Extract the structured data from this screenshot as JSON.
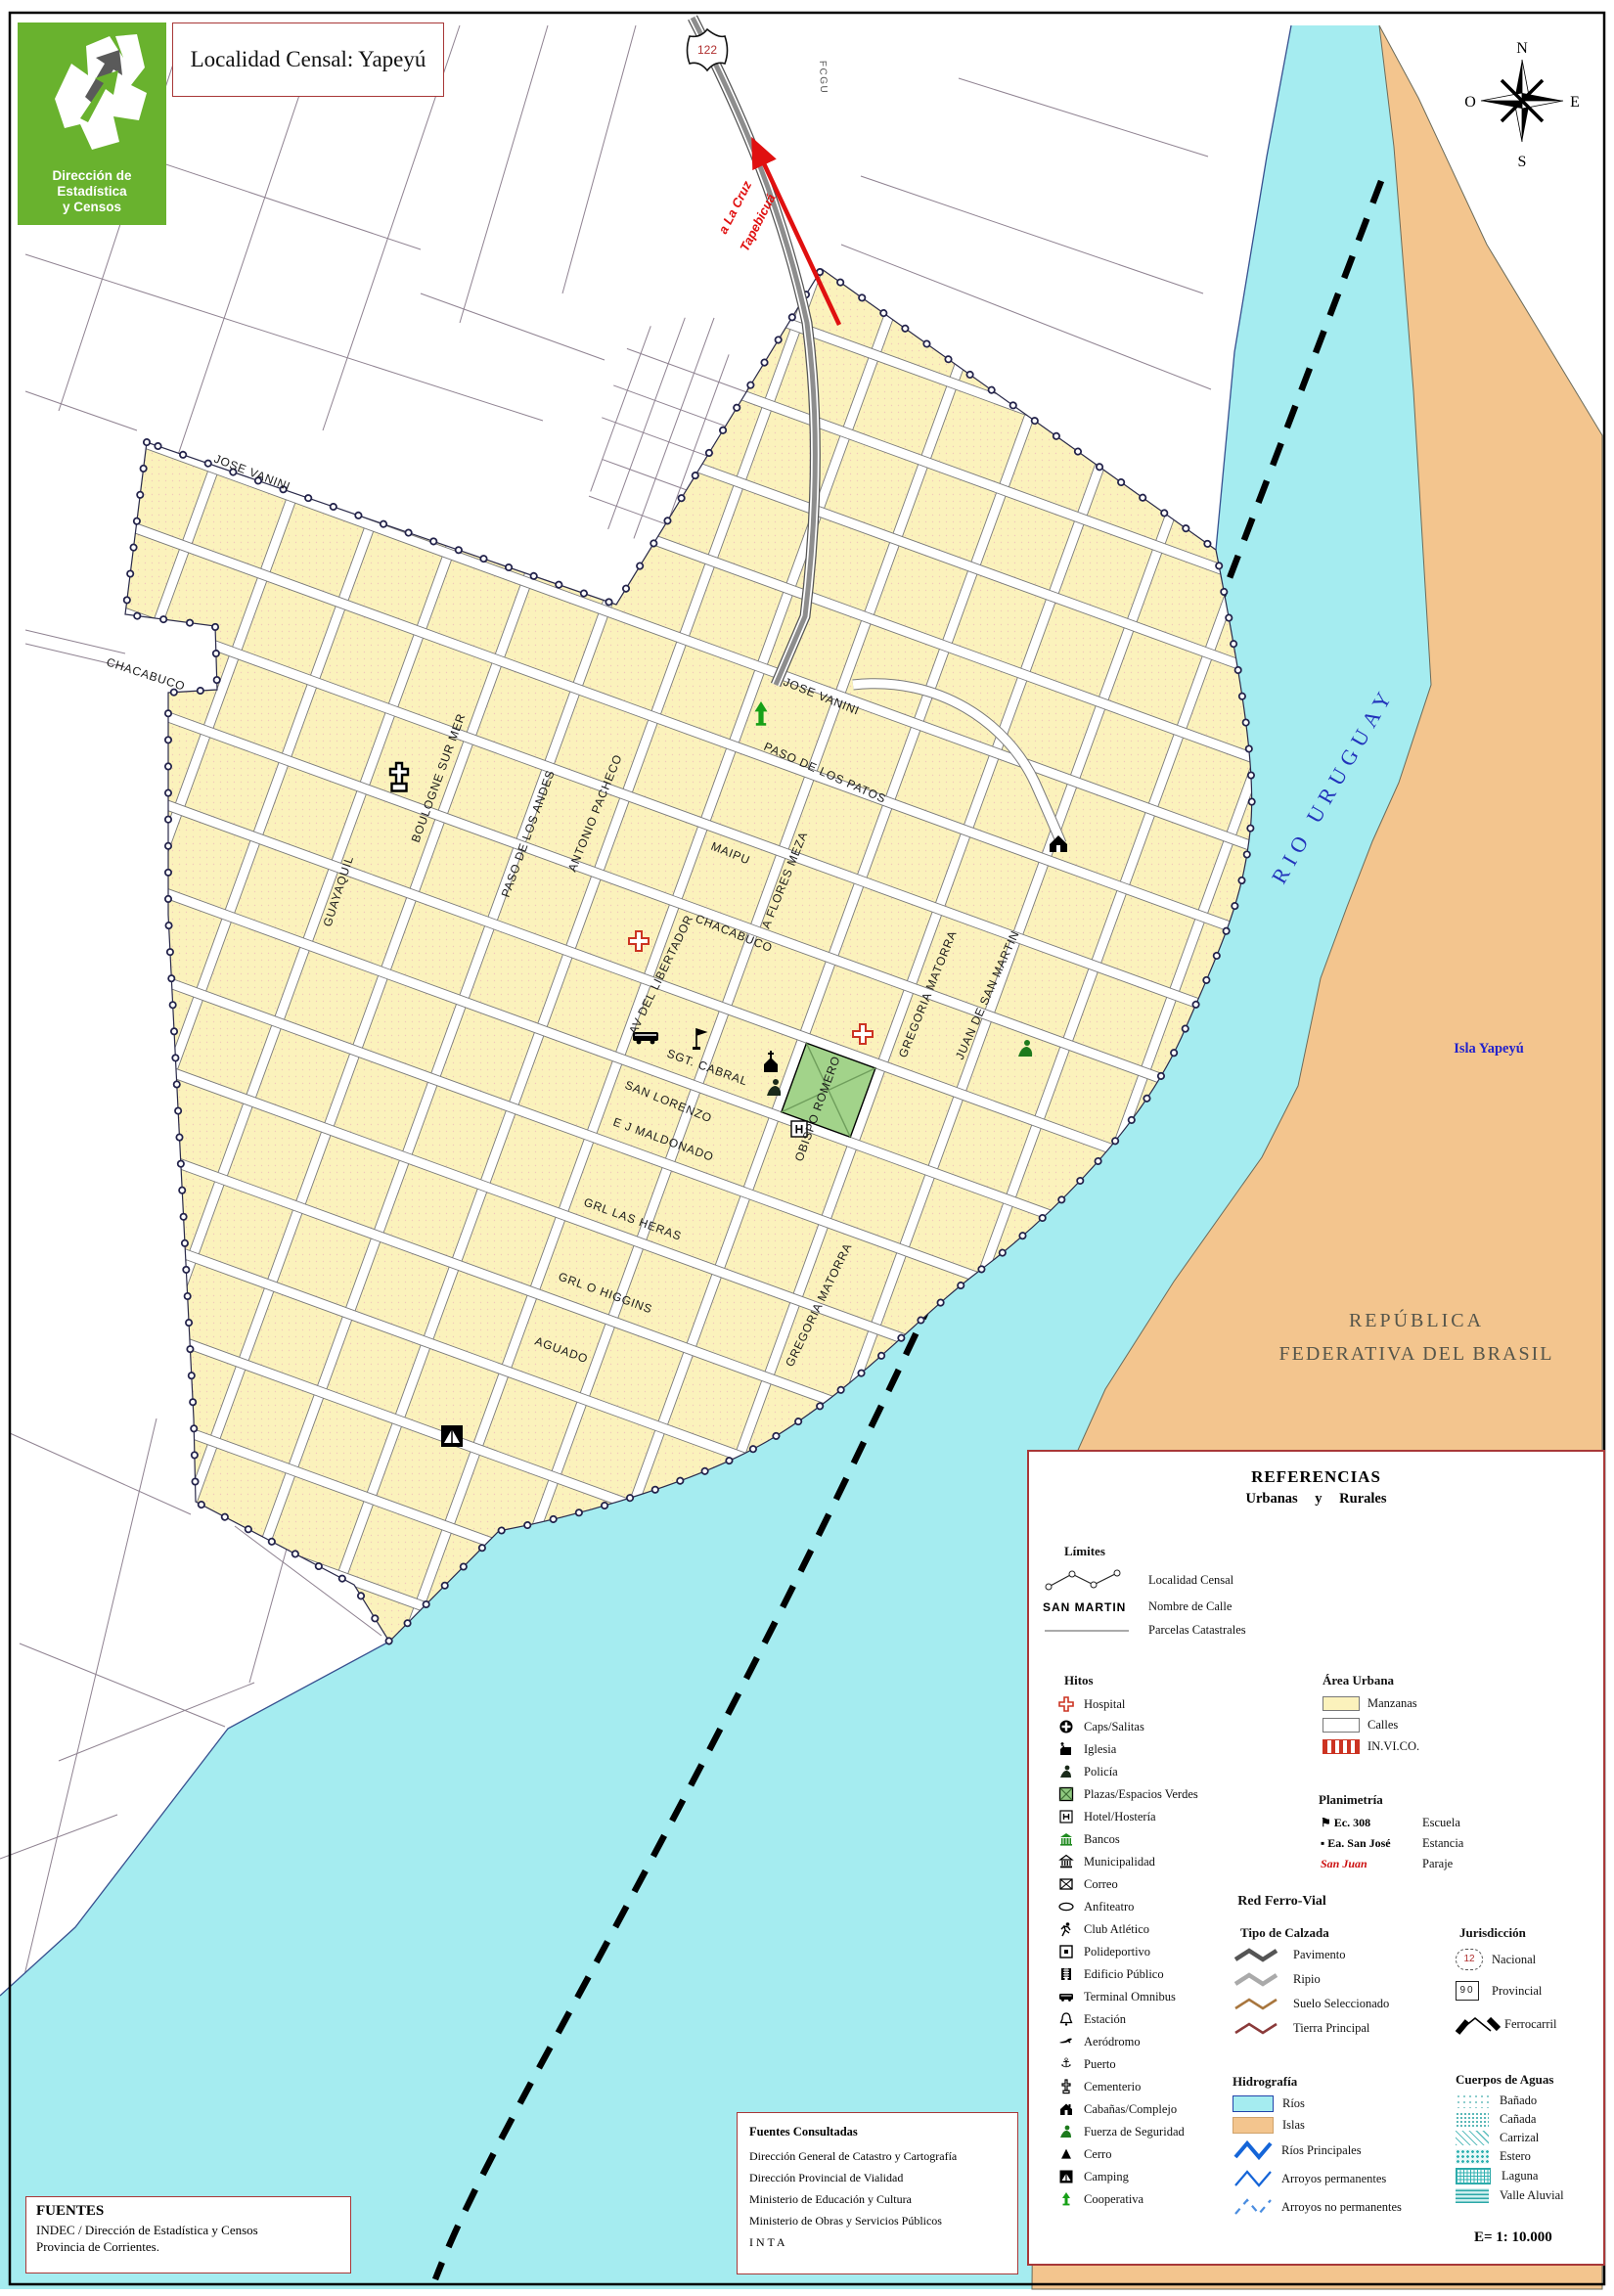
{
  "header": {
    "title": "Localidad Censal: Yapeyú",
    "logo_line1": "Dirección de Estadística",
    "logo_line2": "y Censos"
  },
  "compass": {
    "n": "N",
    "s": "S",
    "e": "E",
    "o": "O"
  },
  "map": {
    "route_shield": "122",
    "railway_label": "FCGU",
    "arrow_label_1": "a La Cruz",
    "arrow_label_2": "Tapebicuá",
    "river_label": "RIO   URUGUAY",
    "island_label": "Isla Yapeyú",
    "country_line1": "REPÚBLICA",
    "country_line2": "FEDERATIVA DEL BRASIL",
    "hotel_letter": "H",
    "streets": [
      "JOSE VANINI",
      "CHACABUCO",
      "JOSE VANINI",
      "PASO DE LOS PATOS",
      "MAIPU",
      "A FLORES MEZA",
      "CHACABUCO",
      "ANTONIO PACHECO",
      "GUAYAQUIL",
      "BOULOGNE SUR MER",
      "PASO DE LOS ANDES",
      "AV DEL LIBERTADOR",
      "SAN LORENZO",
      "OBISPO ROMERO",
      "GREGORIA MATORRA",
      "JUAN DE SAN MARTIN",
      "SGT. CABRAL",
      "E J MALDONADO",
      "GRL LAS HERAS",
      "GRL O HIGGINS",
      "AGUADO",
      "GREGORIA MATORRA"
    ]
  },
  "legend": {
    "title": "REFERENCIAS",
    "subtitle": "Urbanas y Rurales",
    "limites": {
      "title": "Límites",
      "items": [
        {
          "sym": "",
          "label": "Localidad Censal"
        },
        {
          "sym": "SAN MARTIN",
          "label": "Nombre de Calle"
        },
        {
          "sym": "",
          "label": "Parcelas Catastrales"
        }
      ]
    },
    "hitos": {
      "title": "Hitos",
      "items": [
        "Hospital",
        "Caps/Salitas",
        "Iglesia",
        "Policía",
        "Plazas/Espacios Verdes",
        "Hotel/Hostería",
        "Bancos",
        "Municipalidad",
        "Correo",
        "Anfiteatro",
        "Club Atlético",
        "Polideportivo",
        "Edificio Público",
        "Terminal Omnibus",
        "Estación",
        "Aeródromo",
        "Puerto",
        "Cementerio",
        "Cabañas/Complejo",
        "Fuerza de Seguridad",
        "Cerro",
        "Camping",
        "Cooperativa"
      ]
    },
    "area_urbana": {
      "title": "Área Urbana",
      "items": [
        "Manzanas",
        "Calles",
        "IN.VI.CO."
      ]
    },
    "planimetria": {
      "title": "Planimetría",
      "rows": [
        {
          "sym": "Ec. 308",
          "label": "Escuela"
        },
        {
          "sym": "Ea. San José",
          "label": "Estancia"
        },
        {
          "sym": "San Juan",
          "label": "Paraje"
        }
      ]
    },
    "red_ferro": {
      "title": "Red Ferro-Vial",
      "calzada": {
        "title": "Tipo de Calzada",
        "items": [
          "Pavimento",
          "Ripio",
          "Suelo Seleccionado",
          "Tierra Principal"
        ]
      },
      "jurisdiccion": {
        "title": "Jurisdicción",
        "badge_nac": "12",
        "badge_prov": "90",
        "items": [
          "Nacional",
          "Provincial",
          "Ferrocarril"
        ]
      }
    },
    "hidrografia": {
      "title": "Hidrografía",
      "items": [
        "Ríos",
        "Islas",
        "Ríos Principales",
        "Arroyos permanentes",
        "Arroyos no permanentes"
      ]
    },
    "cuerpos": {
      "title": "Cuerpos de Aguas",
      "items": [
        "Bañado",
        "Cañada",
        "Carrizal",
        "Estero",
        "Laguna",
        "Valle Aluvial"
      ]
    },
    "scale": "E= 1: 10.000"
  },
  "fuentes": {
    "title": "FUENTES",
    "line1": "INDEC / Dirección de Estadística y Censos",
    "line2": "Provincia de Corrientes."
  },
  "consultadas": {
    "title": "Fuentes Consultadas",
    "items": [
      "Dirección General de Catastro y Cartografía",
      "Dirección Provincial de Vialidad",
      "Ministerio de Educación y Cultura",
      "Ministerio de Obras y Servicios Públicos",
      "I N T A"
    ]
  },
  "colors": {
    "manzanas": "#FBF2BC",
    "rios": "#A5ECF0",
    "islas": "#F3C58E",
    "brand_green": "#69B22E",
    "legend_border": "#993333"
  }
}
